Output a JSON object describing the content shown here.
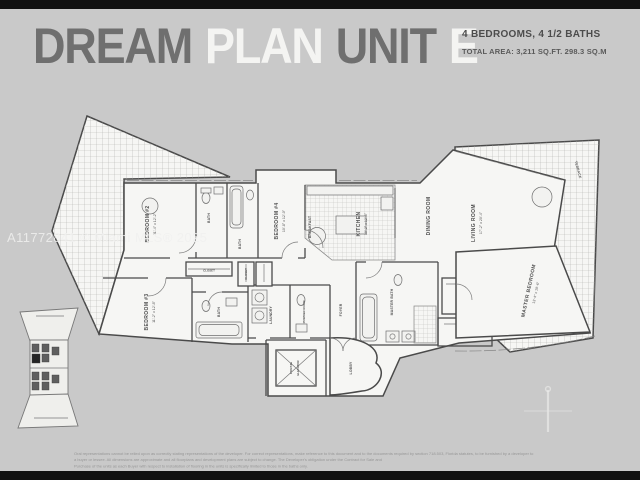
{
  "colors": {
    "background": "#c9c9c9",
    "top_bottom_bar": "#111111",
    "title_dark": "#6f6f6f",
    "title_light": "#f4f4f2",
    "plan_fill": "#f6f6f4",
    "wall": "#4a4a4a",
    "disclaimer_text": "#979797",
    "watermark_text": "#f0f0ee"
  },
  "header": {
    "title_words": [
      {
        "text": "DREAM",
        "tone": "dark"
      },
      {
        "text": "PLAN",
        "tone": "light"
      },
      {
        "text": "UNIT",
        "tone": "dark"
      },
      {
        "text": "E",
        "tone": "light"
      }
    ],
    "stats_line1": "4 BEDROOMS, 4 1/2 BATHS",
    "stats_line2": "TOTAL AREA: 3,211 SQ.FT. 298.3 SQ.M"
  },
  "watermark": "A11772841 © Miami MLS® 2025",
  "floorplan": {
    "labels": {
      "terrace_left": "TERRACE",
      "terrace_right": "TERRACE",
      "bedroom2": "BEDROOM #2",
      "bedroom2_dim": "11'-4\" x 12'-2\"",
      "bedroom3": "BEDROOM #3",
      "bedroom3_dim": "11'-2\" x 12'-8\"",
      "bedroom4": "BEDROOM #4",
      "bedroom4_dim": "10'-8\" x 12'-0\"",
      "bath_a": "BATH",
      "bath_b": "BATH",
      "bath_c": "BATH",
      "kitchen": "KITCHEN",
      "kitchen_dim": "10'-2\" x 12'-6\"",
      "breakfast": "BREAKFAST",
      "dining": "DINING ROOM",
      "living": "LIVING ROOM",
      "living_dim": "17'-2\" x 20'-4\"",
      "master": "MASTER BEDROOM",
      "master_dim": "13'-4\" x 19'-6\"",
      "master_bath": "MASTER BATH",
      "wic_1": "W.I.C.",
      "wic_2": "W.I.C.",
      "laundry": "LAUNDRY",
      "powder": "POWDER ROOM",
      "foyer": "FOYER",
      "lobby": "LOBBY",
      "elevator_line1": "PRIVATE",
      "elevator_line2": "ELEVATOR",
      "closet_1": "CLOSET",
      "closet_2": "CLOSET"
    }
  },
  "footer": {
    "line1": "Oral representations cannot be relied upon as correctly stating representations of the developer. For correct representations, make reference to this document and to the documents required by section 718.503, Florida statutes, to be furnished by a developer to a buyer or lessee. All dimensions are approximate and all floorplans and development plans are subject to change. The Developer's obligation under the Contract for Sale and",
    "line2": "Purchase of the units as each Buyer with respect to installation of flooring in the units is specifically limited to those in the baths only."
  }
}
